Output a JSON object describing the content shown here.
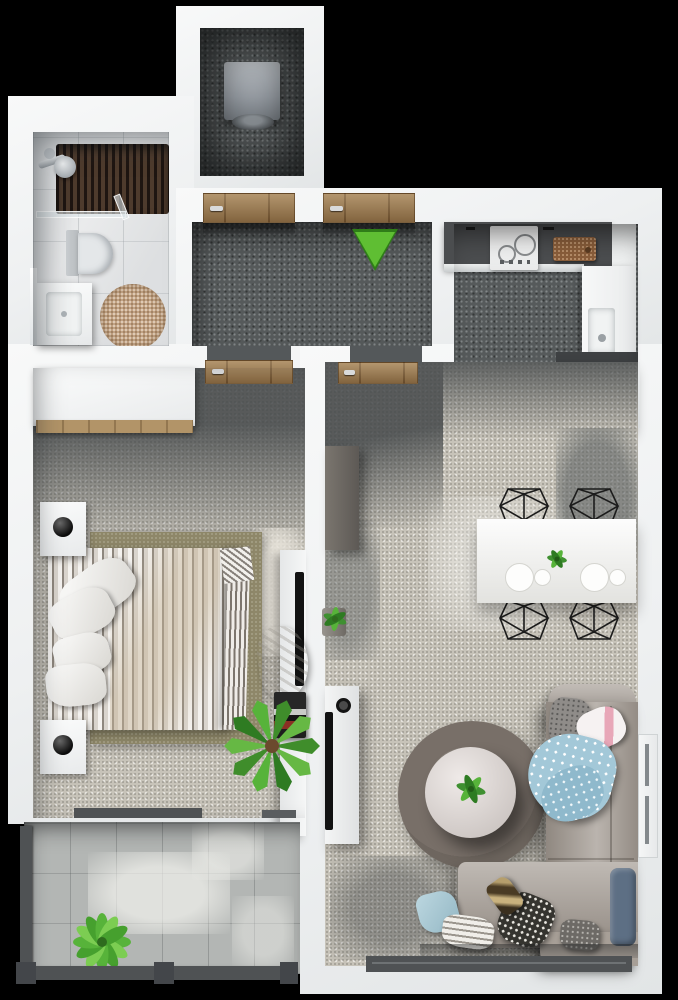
{
  "canvas": {
    "width": 678,
    "height": 1000,
    "background": "#000000",
    "view": "top-down-3d-floor-plan"
  },
  "colors": {
    "background": "#000000",
    "wall": "#eef0f1",
    "floor_dark": "#565a5b",
    "floor_light": "#c7c3b9",
    "marble": "#eaebec",
    "balcony_tile": "#b3b6b4",
    "wood_door": "#9a7a50",
    "shower_slats": "#40312a",
    "olive_rug": "#8e8769",
    "bath_rug": "#c2a384",
    "round_rug": "#746d66",
    "sofa": "#a79f97",
    "sofa_accent": "#5d6f84",
    "blanket": "#a3c8d8",
    "counter_dark": "#4b4d4f",
    "cutting_board": "#8a5e3b",
    "fridge": "#f7f8f8",
    "washer": "#a7adb3",
    "tv": "#121212",
    "railing": "#4f5254",
    "arrow": "#5fbe33",
    "arrow_border": "#2f7d18",
    "plant": "#4d9c31",
    "plant_light": "#7bc94e",
    "table": "#f4f4f3",
    "coffee_table": "#d7d1ce",
    "wardrobe_wood": "#b29468"
  },
  "entrance": {
    "marker": "green-arrow-down",
    "location": "hallway-top-right-door"
  },
  "rooms": [
    {
      "id": "bathroom",
      "furniture": [
        "wood-slat-shower-deck",
        "glass-shower-screen",
        "shower-mixer",
        "toilet",
        "vanity-sink",
        "round-woven-rug"
      ]
    },
    {
      "id": "storage-closet",
      "furniture": [
        "washing-machine"
      ]
    },
    {
      "id": "hallway",
      "furniture": [
        "closet-door",
        "entrance-door",
        "entrance-arrow"
      ]
    },
    {
      "id": "kitchen",
      "furniture": [
        "dark-countertop",
        "cooktop",
        "cutting-board",
        "sink",
        "fridge"
      ]
    },
    {
      "id": "bedroom",
      "furniture": [
        "wardrobe",
        "double-bed",
        "pillows",
        "nightstand-left-top",
        "nightstand-left-bottom",
        "olive-area-rug",
        "tv-console",
        "tv",
        "clothes",
        "palm-plant",
        "door",
        "balcony-slider"
      ]
    },
    {
      "id": "living-room",
      "furniture": [
        "dining-table",
        "wire-chairs-x4",
        "place-settings-x2",
        "centerpiece-plant",
        "sideboard-cabinet",
        "potted-plant",
        "tv-console",
        "tv",
        "round-rug",
        "round-coffee-table",
        "l-shaped-sofa",
        "throw-pillows",
        "polka-dot-blanket",
        "window",
        "door"
      ]
    },
    {
      "id": "balcony",
      "furniture": [
        "green-plant",
        "railing",
        "stone-tiles"
      ]
    }
  ]
}
